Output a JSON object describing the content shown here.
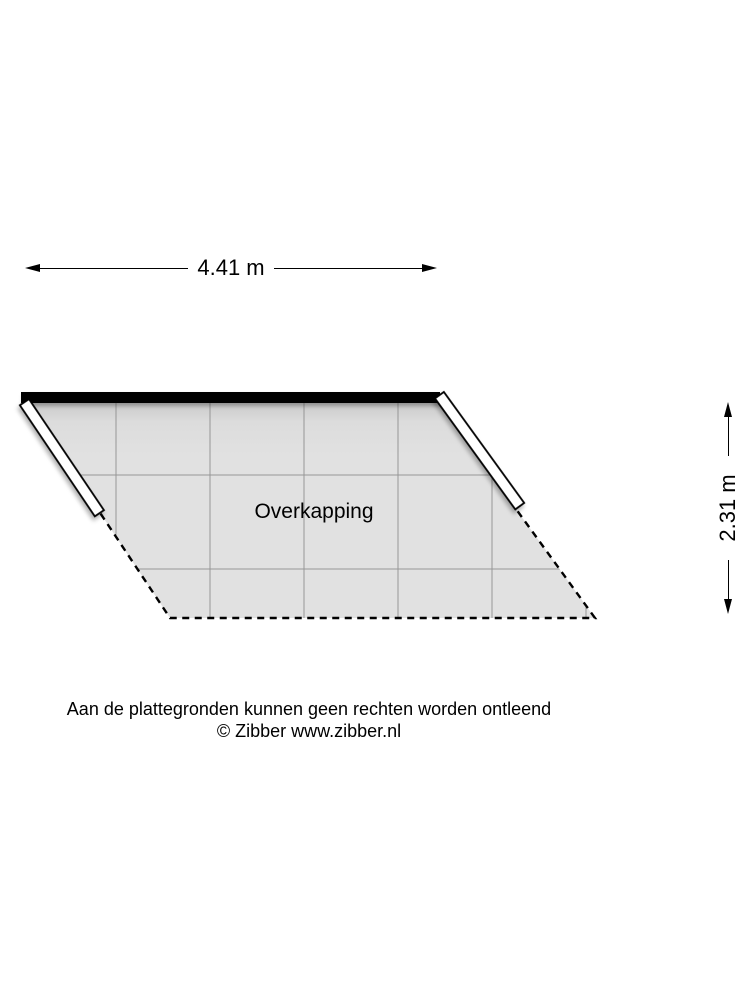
{
  "dimensions": {
    "width_label": "4.41 m",
    "depth_label": "2.31 m"
  },
  "room": {
    "label": "Overkapping"
  },
  "footer": {
    "disclaimer": "Aan de plattegronden kunnen geen rechten worden ontleend",
    "copyright": "© Zibber www.zibber.nl"
  },
  "colors": {
    "background": "#ffffff",
    "floor_fill": "#e1e1e1",
    "floor_shade_top": "#c8c8c8",
    "grid_line": "#969696",
    "wall": "#000000",
    "post_fill": "#ffffff",
    "text": "#000000"
  }
}
